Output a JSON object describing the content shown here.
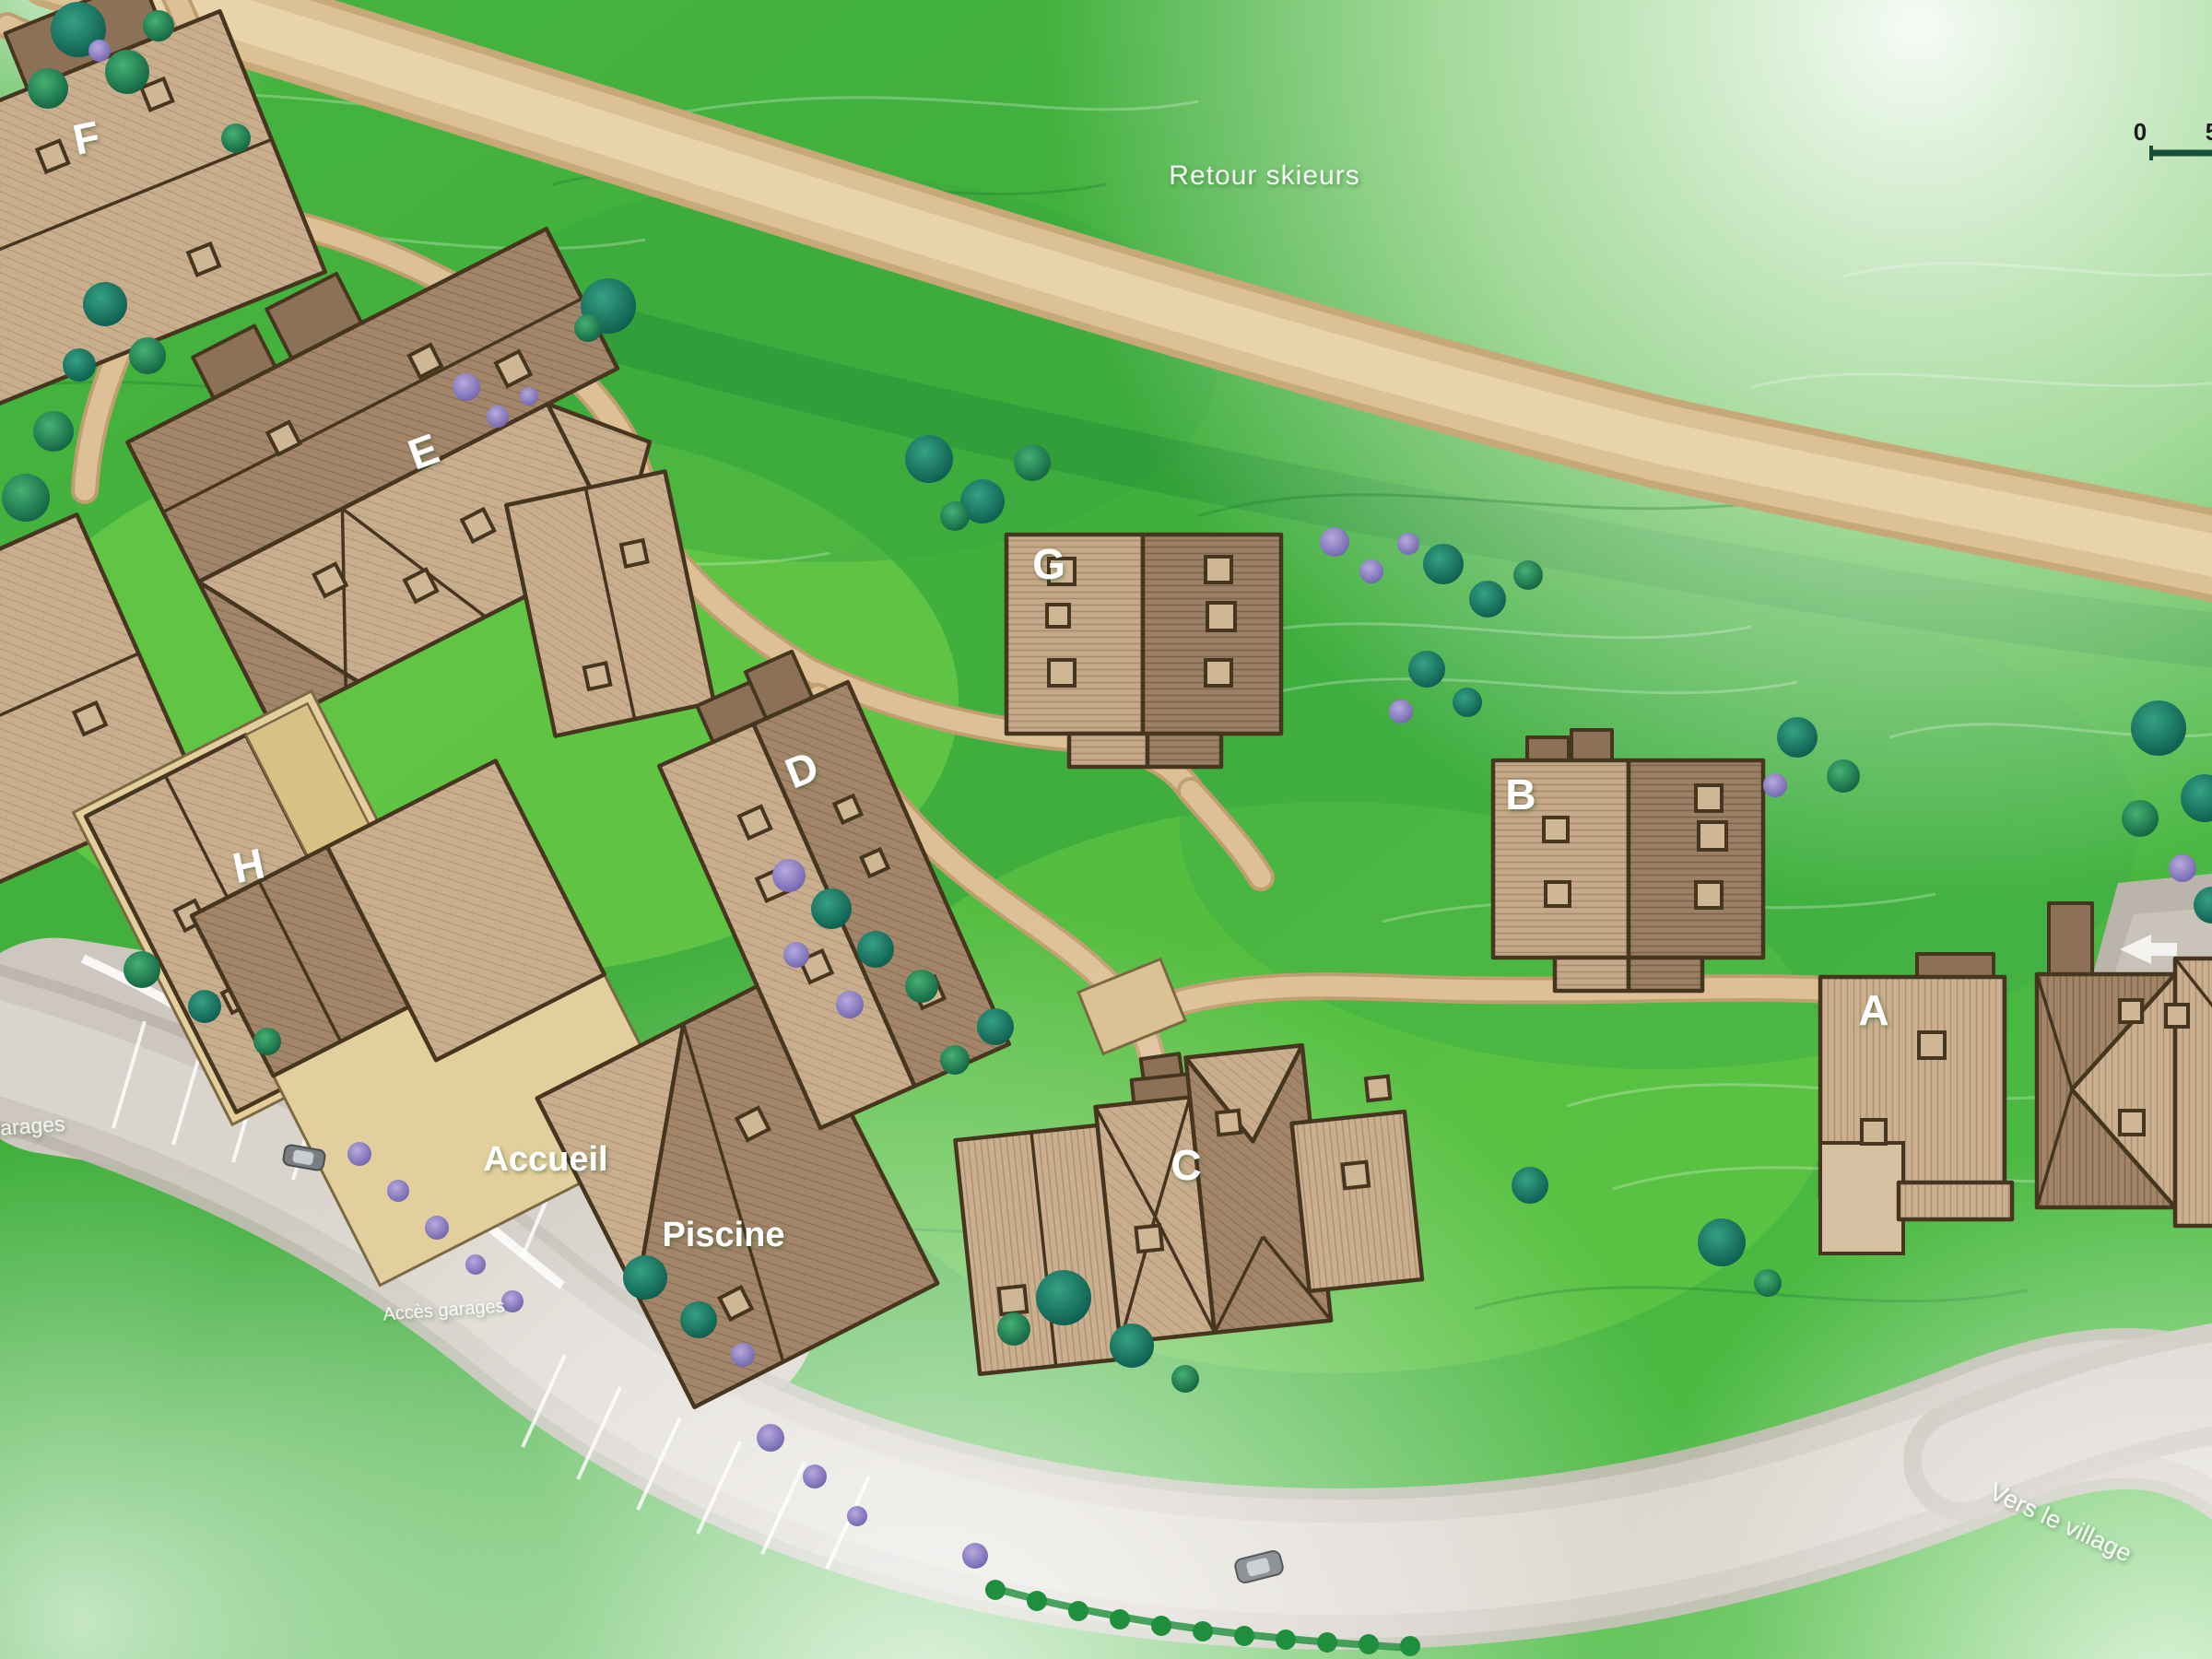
{
  "map": {
    "road_labels": {
      "retour_skieurs": "Retour skieurs",
      "vers_le_village": "Vers le village",
      "acces_garages": "Accès garages",
      "acces_garages_edge": "garages"
    },
    "facility_labels": {
      "accueil": "Accueil",
      "piscine": "Piscine"
    },
    "buildings": [
      {
        "id": "A",
        "label": "A"
      },
      {
        "id": "B",
        "label": "B"
      },
      {
        "id": "C",
        "label": "C"
      },
      {
        "id": "D",
        "label": "D"
      },
      {
        "id": "E",
        "label": "E"
      },
      {
        "id": "F",
        "label": "F"
      },
      {
        "id": "G",
        "label": "G"
      },
      {
        "id": "H",
        "label": "H"
      }
    ],
    "scale_bar": {
      "tick_start": "0",
      "tick_end": "5"
    },
    "colors": {
      "grass": "#45b13b",
      "grass_light": "#8edc52",
      "ski_path": "#ddc096",
      "road": "#cdc7bf",
      "roof_light": "#c9ae8e",
      "roof_dark": "#a3866a",
      "roof_outline": "#46351f",
      "tree_green": "#147a4f",
      "tree_teal": "#0a564a",
      "bush_purple": "#8b7fc2",
      "label_white": "#ffffff",
      "scale_bar": "#174f3b"
    }
  }
}
